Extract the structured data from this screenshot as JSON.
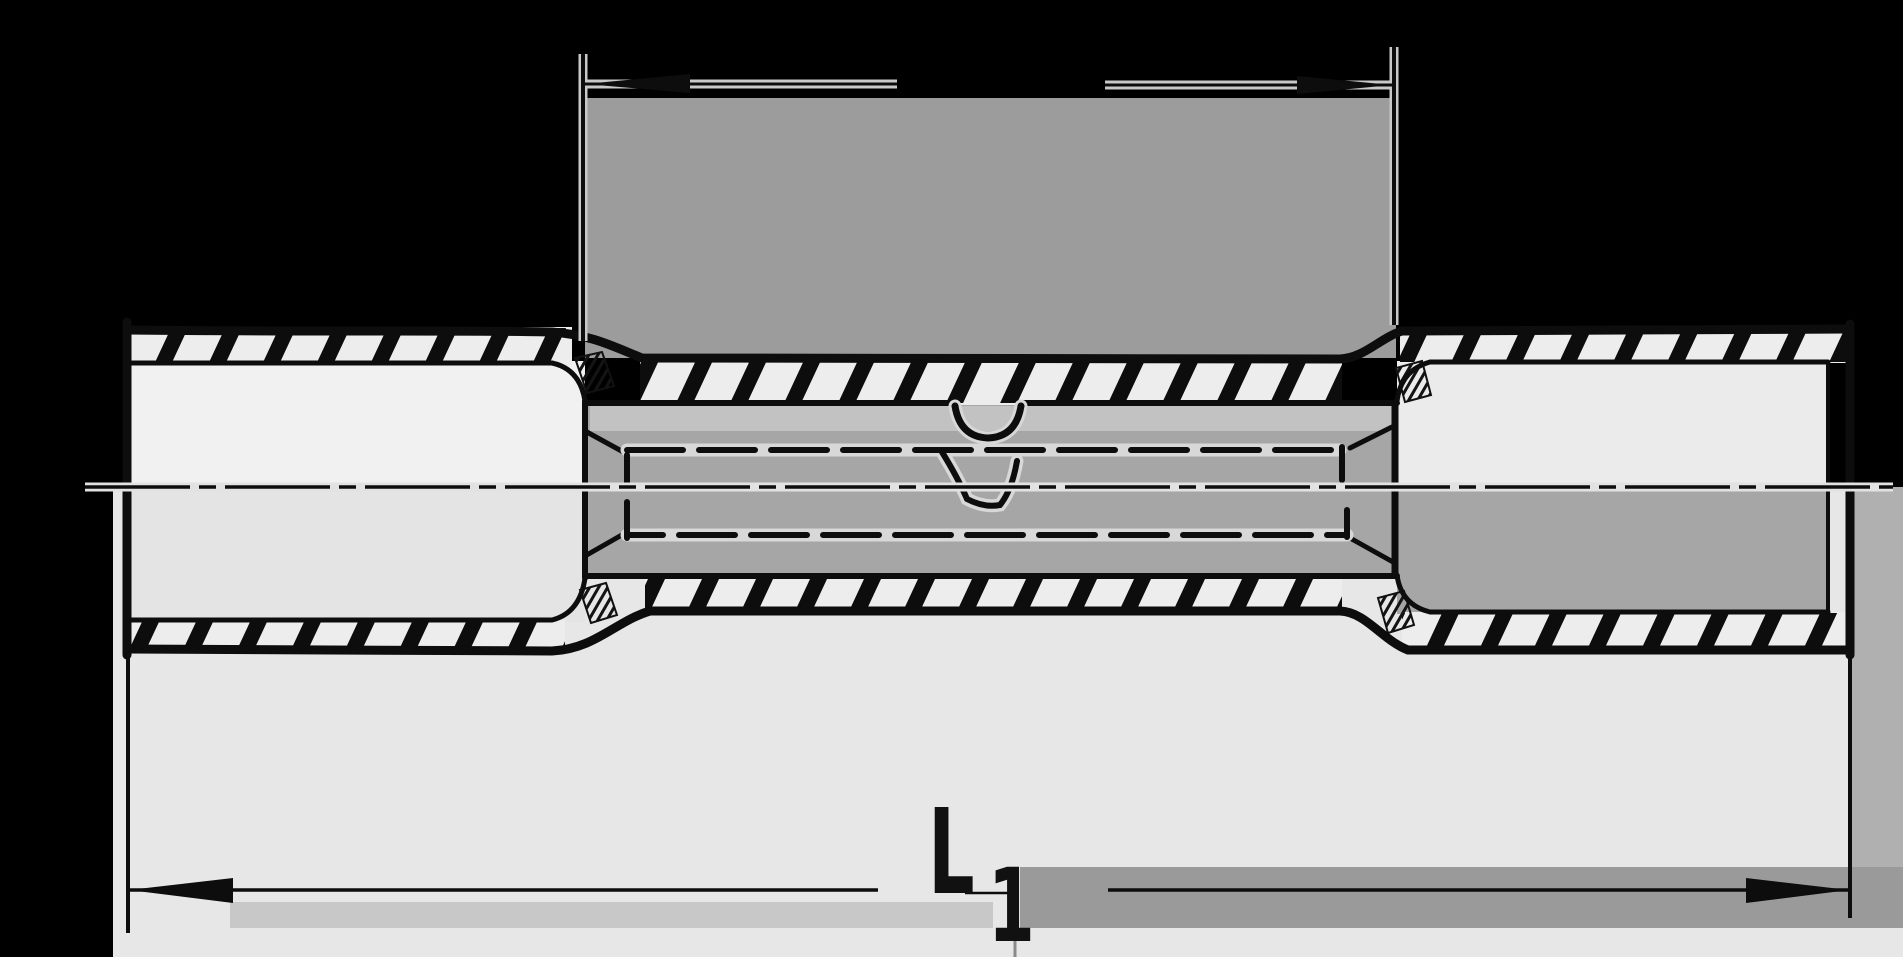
{
  "drawing": {
    "title": "butt-splice-connector-cross-section",
    "type": "technical-line-drawing",
    "dimensions": {
      "top": {
        "label": "",
        "span": "crimp-barrel-section"
      },
      "bottom": {
        "label_main": "L",
        "label_sub": "1",
        "span": "overall-length"
      }
    },
    "linework": {
      "centerline_style": "dash-dot",
      "hidden_barrel_style": "dashed",
      "insulation_style": "diagonal-hatch"
    },
    "colors": {
      "background": "#000000",
      "paper": "#e7e7e7",
      "paper_bright": "#f1f1f1",
      "scan_gray_top": "#9c9c9c",
      "scan_gray_band_right": "#9a9a9a",
      "scan_gray_band_left": "#c8c8c8",
      "scan_gray_column": "#b0b0b0",
      "cavity_gray": "#a6a6a6",
      "ink": "#0d0d0d"
    }
  }
}
